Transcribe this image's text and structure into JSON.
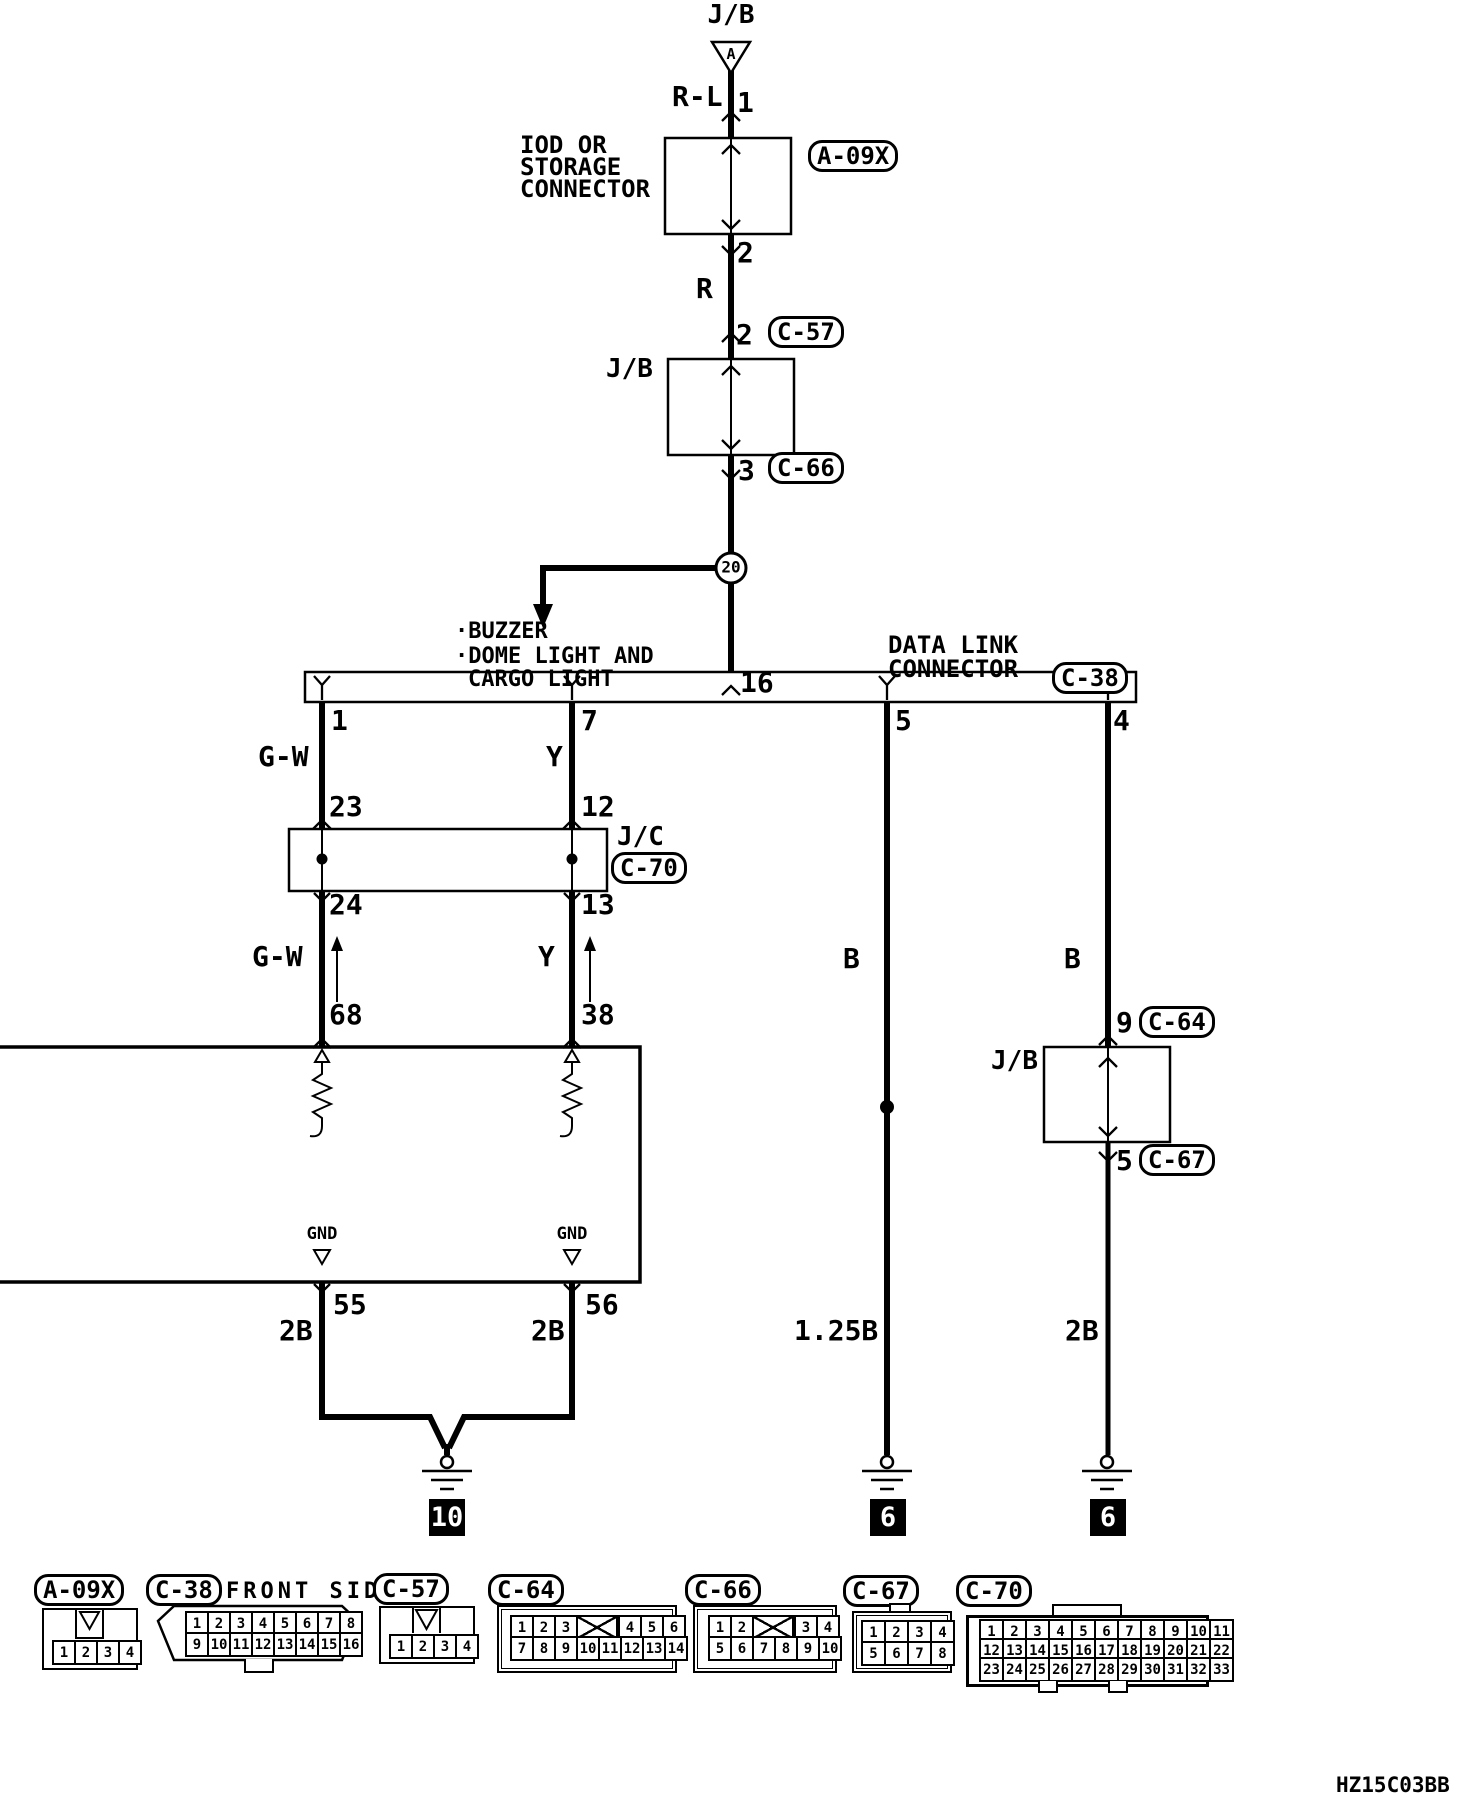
{
  "page": {
    "diagram_code": "HZ15C03BB"
  },
  "colors": {
    "line": "#000000",
    "background": "#ffffff",
    "tag_bg": "#000000",
    "tag_fg": "#ffffff"
  },
  "top_chain": {
    "jb_top": "J/B",
    "triangle_letter": "A",
    "wire_rl": "R-L",
    "pin_1": "1",
    "component_line1": "IOD OR",
    "component_line2": "STORAGE",
    "component_line3": "CONNECTOR",
    "code_a09x": "A-09X",
    "pin_2": "2",
    "wire_r": "R",
    "pin_2_c57": "2",
    "code_c57": "C-57",
    "jb_mid": "J/B",
    "pin_3": "3",
    "code_c66": "C-66",
    "junction_no": "20",
    "branch_line1": "·BUZZER",
    "branch_line2": "·DOME LIGHT AND",
    "branch_line3": "CARGO LIGHT",
    "pin_16": "16"
  },
  "dlc": {
    "name_line1": "DATA LINK",
    "name_line2": "CONNECTOR",
    "code": "C-38",
    "pin_1": "1",
    "pin_7": "7",
    "pin_5": "5",
    "pin_4": "4"
  },
  "gw_branch": {
    "wire_upper": "G-W",
    "pin_23": "23",
    "pin_24": "24",
    "wire_lower": "G-W",
    "pin_68": "68",
    "gnd": "GND",
    "pin_55": "55",
    "wire_2b": "2B"
  },
  "y_branch": {
    "wire_upper": "Y",
    "pin_12": "12",
    "pin_13": "13",
    "wire_lower": "Y",
    "pin_38": "38",
    "gnd": "GND",
    "pin_56": "56",
    "wire_2b": "2B"
  },
  "jc": {
    "label": "J/C",
    "code": "C-70"
  },
  "ground_left": {
    "tag": "10"
  },
  "b_branch": {
    "wire": "B",
    "wire_size": "1.25B",
    "tag": "6"
  },
  "right_branch": {
    "wire": "B",
    "pin_9": "9",
    "code_c64": "C-64",
    "jb": "J/B",
    "pin_5": "5",
    "code_c67": "C-67",
    "wire_2b": "2B",
    "tag": "6"
  },
  "connector_table": {
    "a09x": {
      "code": "A-09X",
      "row1": [
        "1",
        "2",
        "3",
        "4"
      ]
    },
    "c38": {
      "code": "C-38",
      "note": "FRONT SIDE",
      "row1": [
        "1",
        "2",
        "3",
        "4",
        "5",
        "6",
        "7",
        "8"
      ],
      "row2": [
        "9",
        "10",
        "11",
        "12",
        "13",
        "14",
        "15",
        "16"
      ]
    },
    "c57": {
      "code": "C-57",
      "row1": [
        "1",
        "2",
        "3",
        "4"
      ]
    },
    "c64": {
      "code": "C-64",
      "row1a": [
        "1",
        "2",
        "3"
      ],
      "row1b": [
        "4",
        "5",
        "6"
      ],
      "row2": [
        "7",
        "8",
        "9",
        "10",
        "11",
        "12",
        "13",
        "14"
      ]
    },
    "c66": {
      "code": "C-66",
      "row1a": [
        "1",
        "2"
      ],
      "row1b": [
        "3",
        "4"
      ],
      "row2": [
        "5",
        "6",
        "7",
        "8",
        "9",
        "10"
      ]
    },
    "c67": {
      "code": "C-67",
      "row1": [
        "1",
        "2",
        "3",
        "4"
      ],
      "row2": [
        "5",
        "6",
        "7",
        "8"
      ]
    },
    "c70": {
      "code": "C-70",
      "row1": [
        "1",
        "2",
        "3",
        "4",
        "5",
        "6",
        "7",
        "8",
        "9",
        "10",
        "11"
      ],
      "row2": [
        "12",
        "13",
        "14",
        "15",
        "16",
        "17",
        "18",
        "19",
        "20",
        "21",
        "22"
      ],
      "row3": [
        "23",
        "24",
        "25",
        "26",
        "27",
        "28",
        "29",
        "30",
        "31",
        "32",
        "33"
      ]
    }
  }
}
